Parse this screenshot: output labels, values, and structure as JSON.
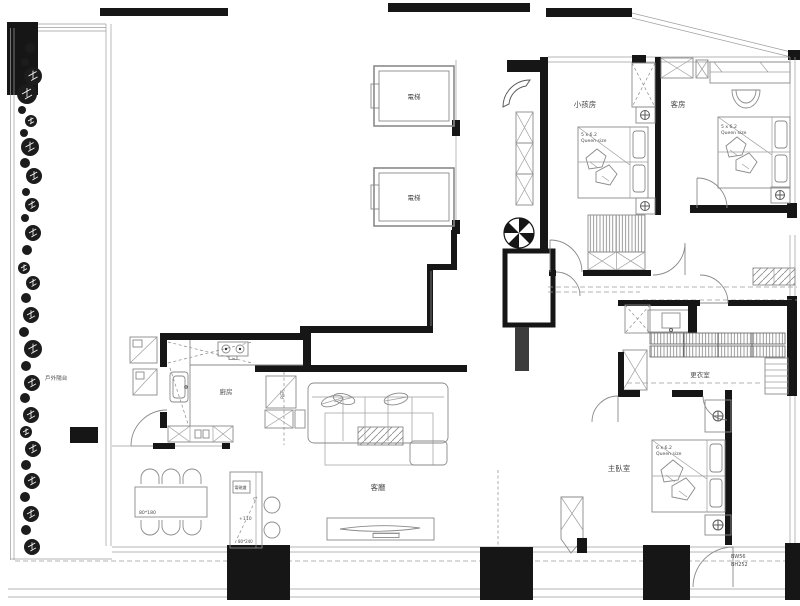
{
  "labels": {
    "balcony": "戶外陽台",
    "elevator_top": "電梯",
    "elevator_bottom": "電梯",
    "kids_room": "小孩房",
    "guest_room": "客房",
    "walk_in_closet": "更衣室",
    "master_bedroom": "主臥室",
    "living_room": "客廳",
    "kitchen": "廚房",
    "refrigerator": "REF",
    "induction_cooker": "電磁爐"
  },
  "beds": {
    "kids": {
      "size": "5 x 6.2",
      "type": "Queen size"
    },
    "guest": {
      "size": "5 x 6.2",
      "type": "Queen size"
    },
    "master": {
      "size": "6 x 6.2",
      "type": "Queen size"
    }
  },
  "dimensions": {
    "dining_table": "80*180",
    "island_counter": "80*240",
    "island_height": "+110",
    "window_width": "BW56",
    "window_height": "BH252"
  },
  "colors": {
    "wall": "#161616",
    "furniture_line": "#8a8a8a",
    "text": "#4c4c4c"
  }
}
